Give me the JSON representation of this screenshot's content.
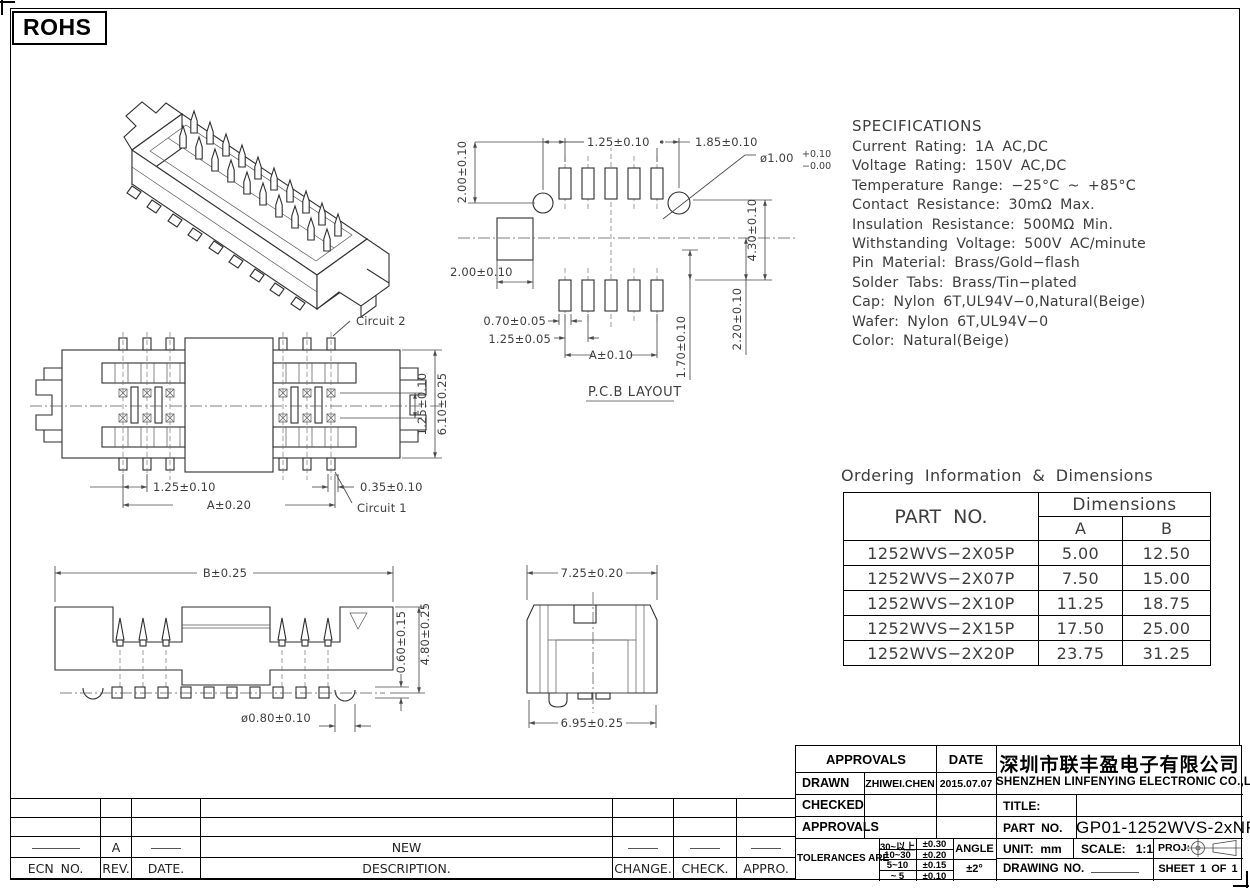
{
  "badge": {
    "rohs": "ROHS"
  },
  "spec": {
    "title": "SPECIFICATIONS",
    "lines": [
      "Current Rating: 1A AC,DC",
      "Voltage Rating: 150V AC,DC",
      "Temperature Range: −25°C ~ +85°C",
      "Contact Resistance: 30mΩ Max.",
      "Insulation Resistance: 500MΩ Min.",
      "Withstanding Voltage: 500V AC/minute",
      "Pin Material: Brass/Gold−flash",
      "Solder Tabs: Brass/Tin−plated",
      "Cap: Nylon 6T,UL94V−0,Natural(Beige)",
      "Wafer: Nylon 6T,UL94V−0",
      "Color: Natural(Beige)"
    ]
  },
  "ordering": {
    "title": "Ordering Information & Dimensions",
    "part_no_header": "PART NO.",
    "dimensions_header": "Dimensions",
    "col_a": "A",
    "col_b": "B",
    "rows": [
      {
        "part": "1252WVS−2X05P",
        "a": "5.00",
        "b": "12.50"
      },
      {
        "part": "1252WVS−2X07P",
        "a": "7.50",
        "b": "15.00"
      },
      {
        "part": "1252WVS−2X10P",
        "a": "11.25",
        "b": "18.75"
      },
      {
        "part": "1252WVS−2X15P",
        "a": "17.50",
        "b": "25.00"
      },
      {
        "part": "1252WVS−2X20P",
        "a": "23.75",
        "b": "31.25"
      }
    ]
  },
  "pcb": {
    "title": "P.C.B LAYOUT",
    "dim_v200": "2.00±0.10",
    "dim_125": "1.25±0.10",
    "dim_185": "1.85±0.10",
    "hole_dia": "ø1.00",
    "hole_tol_plus": "+0.10",
    "hole_tol_minus": "−0.00",
    "dim_h200": "2.00±0.10",
    "dim_430": "4.30±0.10",
    "dim_220": "2.20±0.10",
    "dim_170": "1.70±0.10",
    "dim_070": "0.70±0.05",
    "dim_125b": "1.25±0.05",
    "dim_a": "A±0.10"
  },
  "top_view": {
    "circuit2": "Circuit 2",
    "circuit1": "Circuit 1",
    "dim_row": "1.25±0.10",
    "dim_width": "6.10±0.25",
    "dim_pitch": "1.25±0.10",
    "dim_a": "A±0.20",
    "dim_tab": "0.35±0.10"
  },
  "front_view": {
    "dim_b": "B±0.25",
    "dim_060": "0.60±0.15",
    "dim_480": "4.80±0.25",
    "dim_foot": "ø0.80±0.10"
  },
  "side_view": {
    "dim_top": "7.25±0.20",
    "dim_bottom": "6.95±0.25"
  },
  "revision": {
    "rev_value": "A",
    "description_value": "NEW",
    "headers": {
      "ecn": "ECN NO.",
      "rev": "REV.",
      "date": "DATE.",
      "description": "DESCRIPTION.",
      "change": "CHANGE.",
      "check": "CHECK.",
      "appro": "APPRO."
    }
  },
  "title_block": {
    "approvals": "APPROVALS",
    "date": "DATE",
    "drawn": "DRAWN",
    "drawn_by": "ZHIWEI.CHEN",
    "drawn_date": "2015.07.07",
    "checked": "CHECKED",
    "approvals_row": "APPROVALS",
    "tolerances": "TOLERANCES ARE",
    "tol": [
      {
        "range": "30~以上",
        "value": "±0.30"
      },
      {
        "range": "10~30",
        "value": "±0.20"
      },
      {
        "range": "5~10",
        "value": "±0.15"
      },
      {
        "range": "~ 5",
        "value": "±0.10"
      }
    ],
    "angle": "ANGLE",
    "angle_value": "±2°",
    "company_cn": "深圳市联丰盈电子有限公司",
    "company_en": "SHENZHEN LINFENYING ELECTRONIC CO.,LTD",
    "title_label": "TITLE:",
    "part_no_label": "PART NO.",
    "part_no": "GP01-1252WVS-2xNP",
    "unit_label": "UNIT:",
    "unit": "mm",
    "scale_label": "SCALE:",
    "scale": "1:1",
    "proj_label": "PROJ:",
    "drawing_no_label": "DRAWING NO.",
    "sheet": "SHEET 1 OF 1"
  }
}
